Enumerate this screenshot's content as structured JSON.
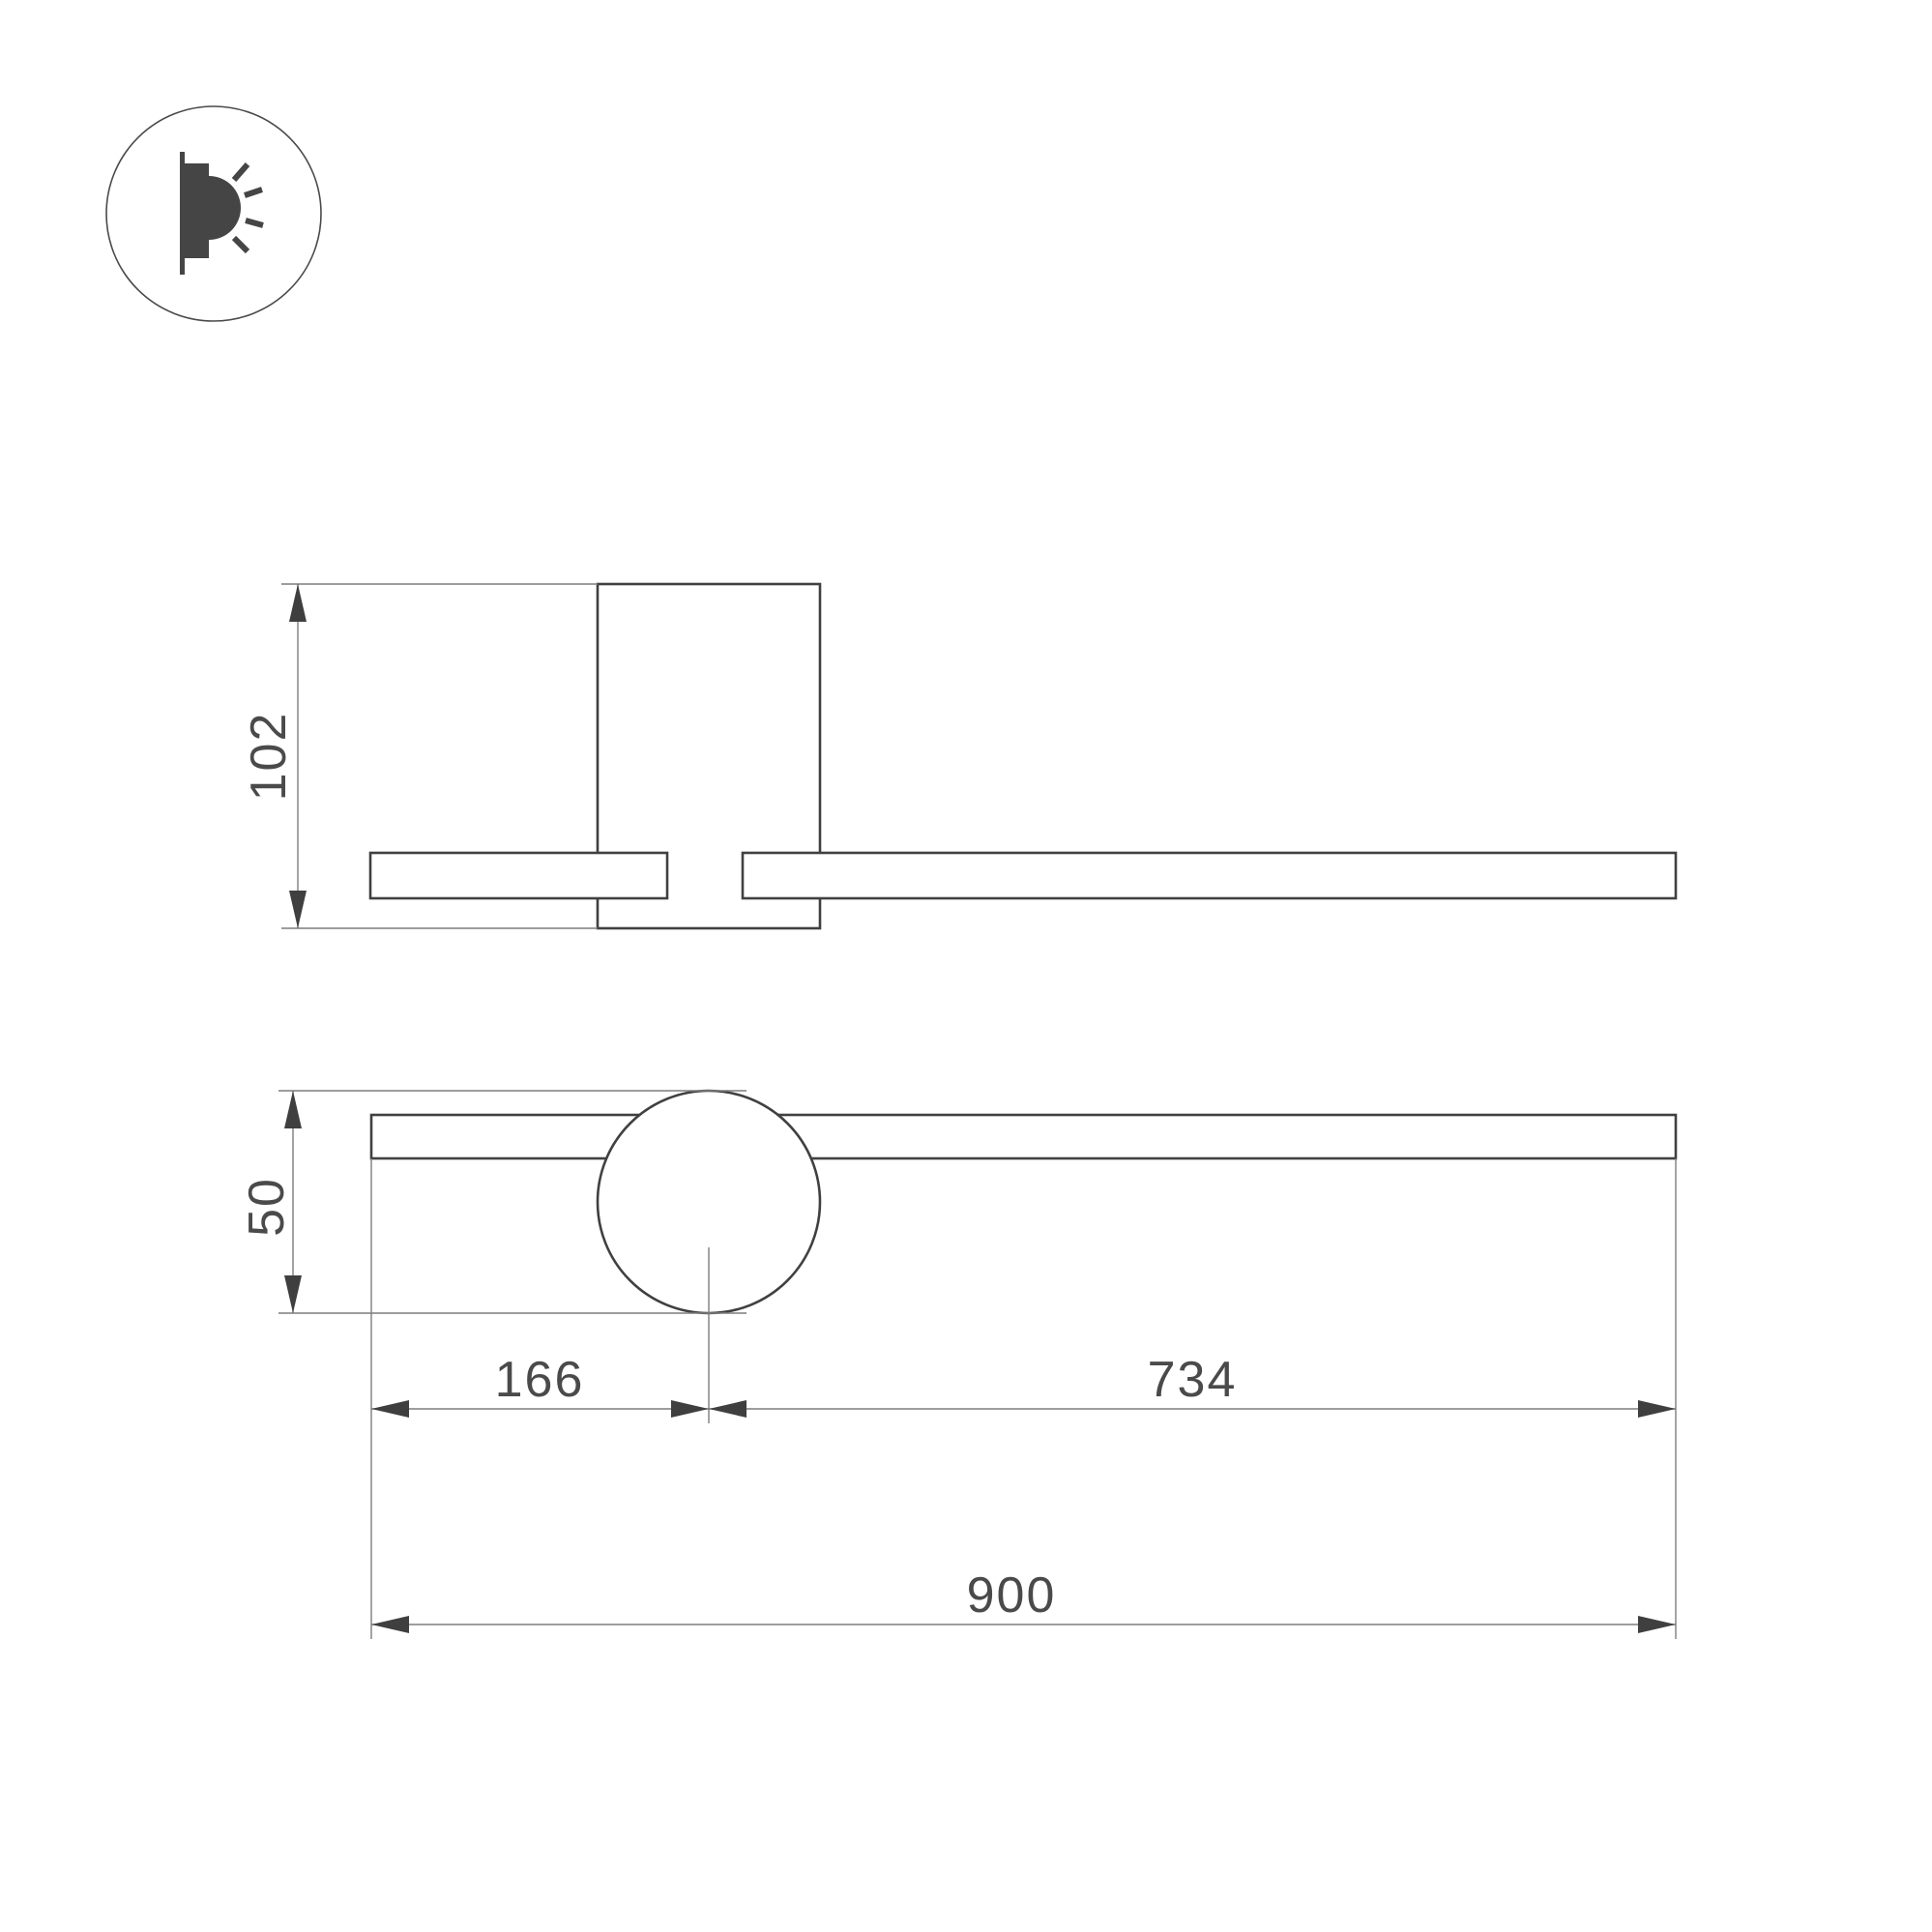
{
  "drawing": {
    "type": "technical-dimension-drawing",
    "subject": "wall lamp, two orthographic views",
    "icon": {
      "name": "wall-light-emitting-icon"
    },
    "dimensions": {
      "side_height": "102",
      "ball_diameter": "50",
      "left_offset": "166",
      "right_span": "734",
      "total_length": "900"
    },
    "colors": {
      "background": "#ffffff",
      "outline": "#404040",
      "dimension_line": "#7d7d7d",
      "arrow": "#3f3f3f",
      "text": "#4a4a4a",
      "icon": "#454545"
    }
  }
}
